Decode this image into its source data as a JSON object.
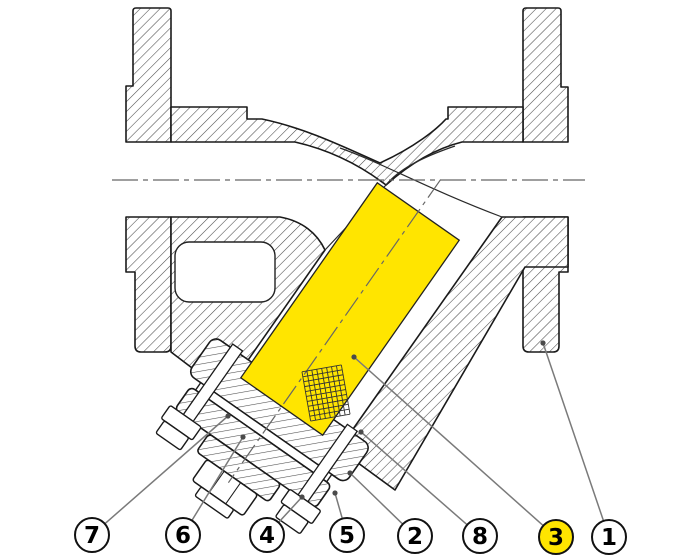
{
  "figure": {
    "type": "y-strainer-sectional-drawing",
    "highlighted_part_balloon": "3"
  },
  "colors": {
    "highlight": "#FFE500",
    "outline": "#1a1a1a",
    "hatch": "#4a4a4a",
    "leader": "#7a7a7a",
    "leader_dot": "#4a4a4a",
    "centerline": "#666666",
    "balloon_fill": "#ffffff",
    "balloon_stroke": "#111111",
    "balloon_text": "#000000",
    "background": "#ffffff"
  },
  "balloon_radius": 17,
  "balloons": [
    {
      "label": "7",
      "cx": 92,
      "cy": 535,
      "highlighted": false,
      "target": {
        "x": 228,
        "y": 416
      }
    },
    {
      "label": "6",
      "cx": 183,
      "cy": 535,
      "highlighted": false,
      "target": {
        "x": 243,
        "y": 437
      }
    },
    {
      "label": "4",
      "cx": 267,
      "cy": 535,
      "highlighted": false,
      "target": {
        "x": 302,
        "y": 497
      }
    },
    {
      "label": "5",
      "cx": 347,
      "cy": 535,
      "highlighted": false,
      "target": {
        "x": 335,
        "y": 493
      }
    },
    {
      "label": "2",
      "cx": 415,
      "cy": 536,
      "highlighted": false,
      "target": {
        "x": 350,
        "y": 473
      }
    },
    {
      "label": "8",
      "cx": 480,
      "cy": 536,
      "highlighted": false,
      "target": {
        "x": 361,
        "y": 432
      }
    },
    {
      "label": "3",
      "cx": 556,
      "cy": 537,
      "highlighted": true,
      "target": {
        "x": 354,
        "y": 357
      }
    },
    {
      "label": "1",
      "cx": 609,
      "cy": 537,
      "highlighted": false,
      "target": {
        "x": 543,
        "y": 343
      }
    }
  ]
}
